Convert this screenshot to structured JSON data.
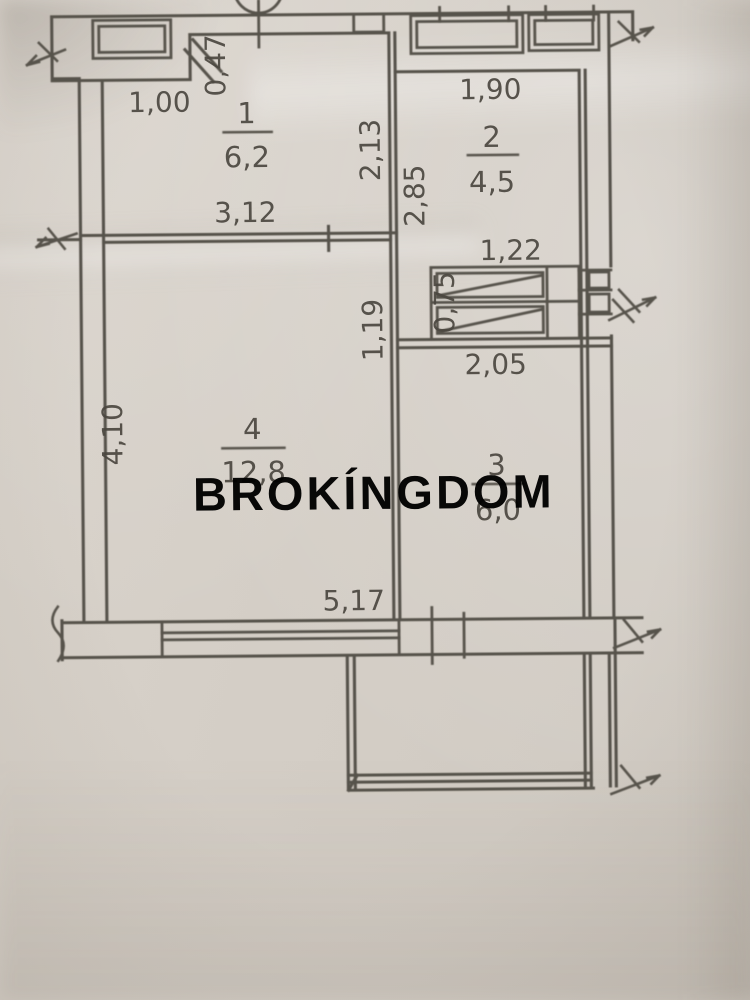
{
  "watermark": {
    "text": "BROKÍNGDOM",
    "color": "#2b4f44"
  },
  "colors": {
    "paper": "#d4cec6",
    "ink": "#57524b",
    "label": "#4b4740"
  },
  "rooms": [
    {
      "number": "1",
      "area": "6,2"
    },
    {
      "number": "2",
      "area": "4,5"
    },
    {
      "number": "3",
      "area": "6,0"
    },
    {
      "number": "4",
      "area": "12,8"
    }
  ],
  "dimensions": {
    "niche_width": "1,00",
    "niche_depth": "0,47",
    "room1_width": "3,12",
    "room1_height": "2,13",
    "room2_width": "1,90",
    "room2_height": "2,85",
    "shaft_width": "1,22",
    "shaft_height": "0,75",
    "wall_segment": "1,19",
    "room3_width": "2,05",
    "room4_height": "4,10",
    "bottom_wall_width": "5,17"
  }
}
